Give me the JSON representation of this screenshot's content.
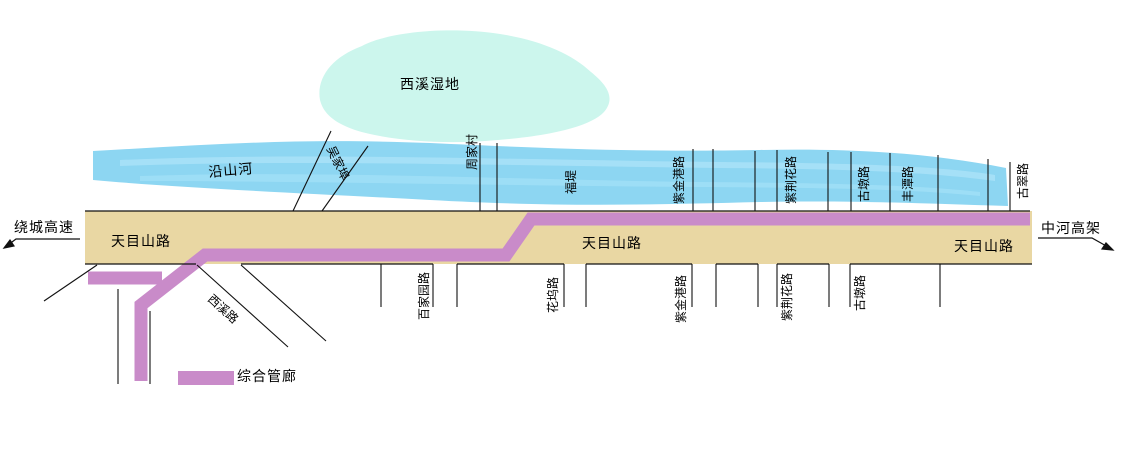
{
  "map": {
    "wetland_label": "西溪湿地",
    "river_label": "沿山河",
    "west_end_label": "绕城高速",
    "east_end_label": "中河高架",
    "road_labels": {
      "west": "天目山路",
      "middle": "天目山路",
      "east": "天目山路"
    },
    "creek_label": "吴家埠",
    "north_side_labels": [
      "周家村",
      "福堤",
      "紫金港路",
      "紫荆花路",
      "古墩路",
      "丰潭路",
      "古翠路"
    ],
    "south_side_labels": [
      "西溪路",
      "百家园路",
      "花坞路",
      "紫金港路",
      "紫荆花路",
      "古墩路"
    ],
    "legend": {
      "label": "综合管廊",
      "color": "#c98bc9"
    },
    "colors": {
      "river": "#8dd6f2",
      "river_streak": "#a9e2f8",
      "wetland": "#ccf6ed",
      "road": "#e9d7a3",
      "tunnel": "#c98bc9",
      "line": "#111111"
    }
  }
}
